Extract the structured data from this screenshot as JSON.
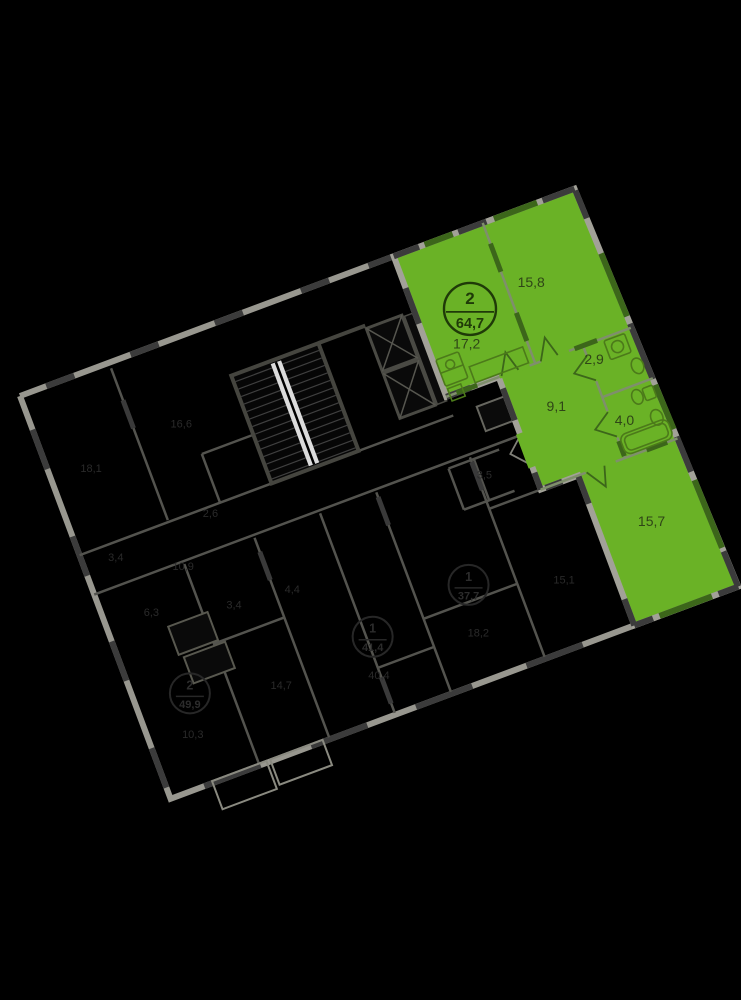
{
  "plan": {
    "rotation_deg": -20.5,
    "colors": {
      "highlight_fill": "#6ab226",
      "highlight_window": "#3c661a",
      "wall_light": "#9b9b93",
      "wall_dark": "#3b3b3b",
      "dim_wall": "#53534e",
      "label_on_green": "#2f4517",
      "dim_label": "#2a2a2a"
    },
    "apartment": {
      "badge": {
        "rooms": "2",
        "total_area": "64,7"
      },
      "rooms": [
        {
          "key": "living-kitchen",
          "area": "17,2"
        },
        {
          "key": "bedroom",
          "area": "15,8"
        },
        {
          "key": "wc",
          "area": "2,9"
        },
        {
          "key": "hallway",
          "area": "9,1"
        },
        {
          "key": "bathroom",
          "area": "4,0"
        },
        {
          "key": "room",
          "area": "15,7"
        }
      ]
    },
    "background": {
      "labels": [
        "16,6",
        "18,1",
        "2,6",
        "3,4",
        "10,9",
        "6,3",
        "3,4",
        "4,4",
        "3,5",
        "10,3",
        "14,7",
        "40,4",
        "18,2",
        "15,1"
      ],
      "badges": [
        {
          "rooms": "2",
          "total_area": "49,9"
        },
        {
          "rooms": "1",
          "total_area": "41,4"
        },
        {
          "rooms": "1",
          "total_area": "37,7"
        }
      ]
    }
  }
}
